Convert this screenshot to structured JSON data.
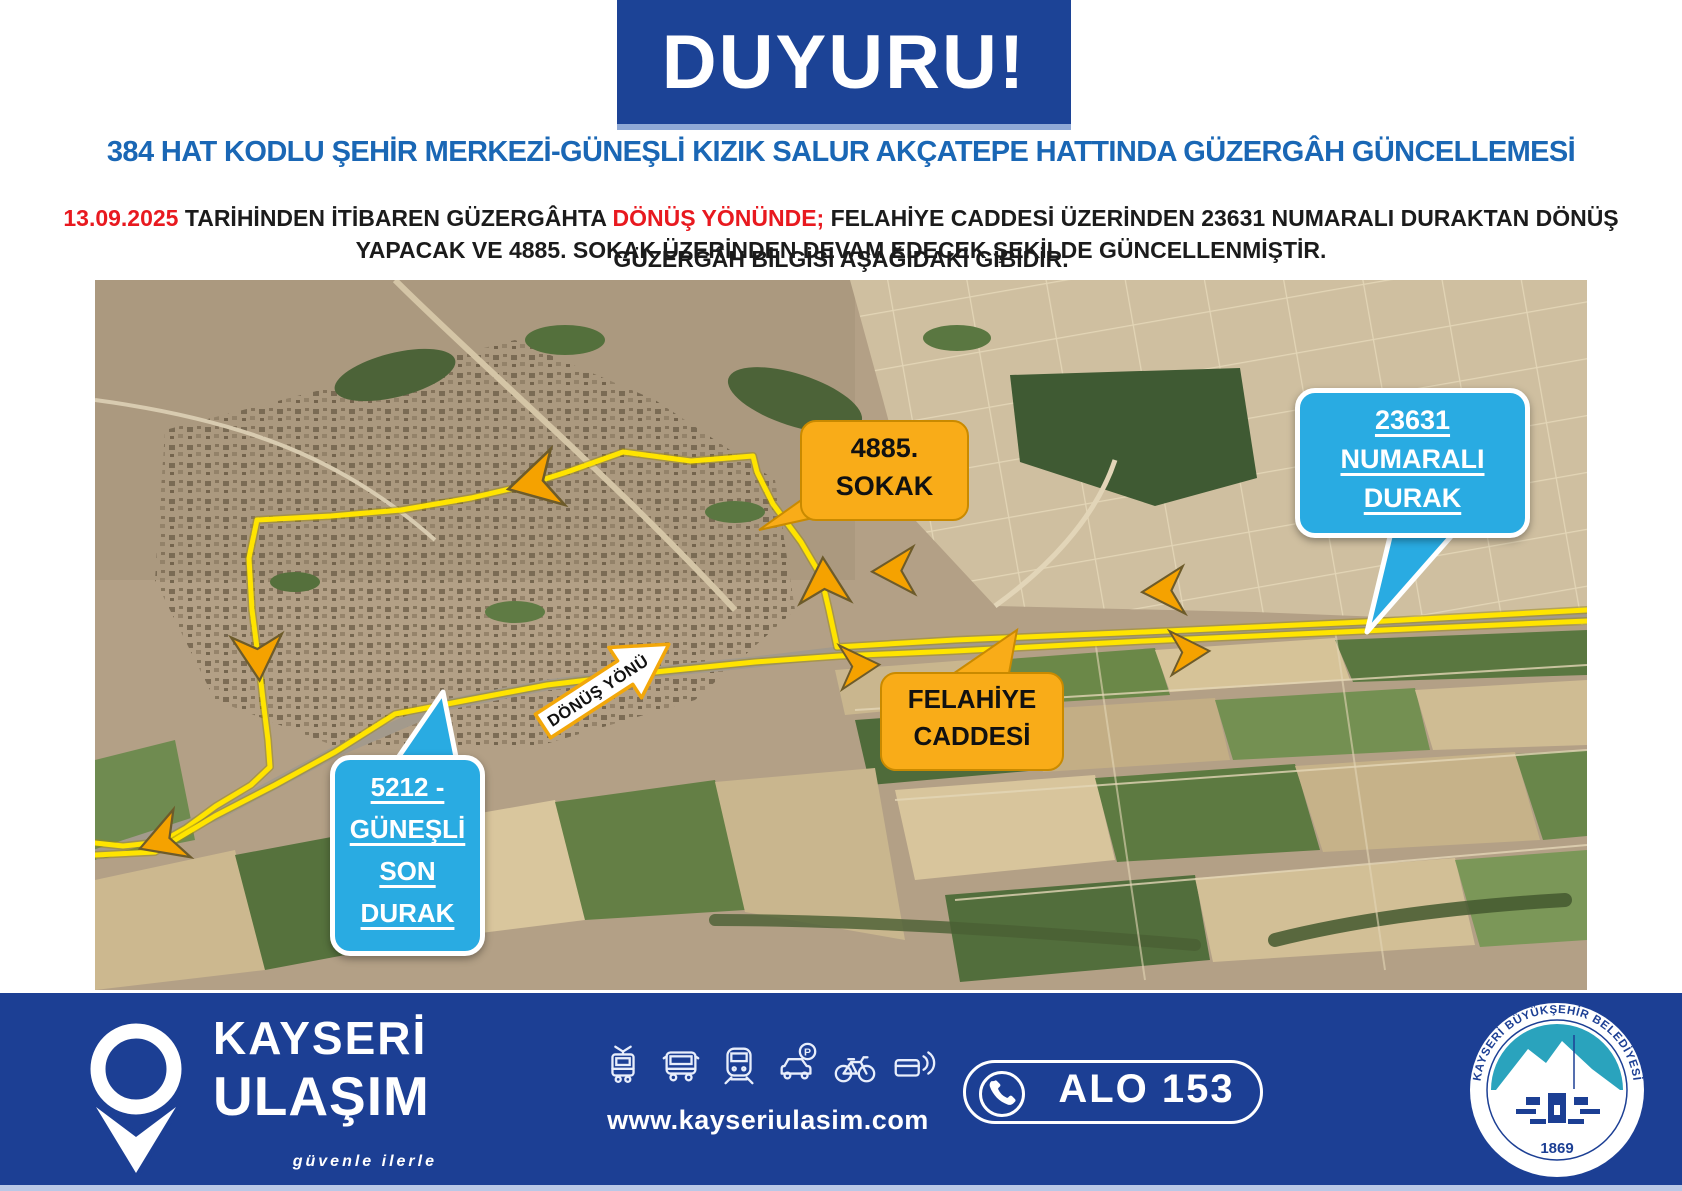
{
  "header": {
    "banner": "DUYURU!",
    "title": "384 HAT KODLU ŞEHİR MERKEZİ-GÜNEŞLİ KIZIK SALUR AKÇATEPE HATTINDA GÜZERGÂH GÜNCELLEMESİ",
    "body": {
      "date": "13.09.2025",
      "seg1": " TARİHİNDEN İTİBAREN GÜZERGÂHTA ",
      "highlight": "DÖNÜŞ YÖNÜNDE;",
      "seg2": " FELAHİYE CADDESİ ÜZERİNDEN 23631 NUMARALI DURAKTAN DÖNÜŞ YAPACAK VE 4885. SOKAK ÜZERİNDEN DEVAM EDECEK ŞEKİLDE GÜNCELLENMİŞTİR."
    },
    "subtitle": "GÜZERGÂH BİLGİSİ AŞAĞIDAKİ GİBİDİR."
  },
  "map": {
    "direction_label": "DÖNÜŞ YÖNÜ",
    "callouts": {
      "sokak4885": {
        "line1": "4885.",
        "line2": "SOKAK"
      },
      "durak23631": {
        "line1": "23631",
        "line2": "NUMARALI",
        "line3": "DURAK"
      },
      "felahiye": {
        "line1": "FELAHİYE",
        "line2": "CADDESİ"
      },
      "gunesli": {
        "line1": "5212 -",
        "line2": "GÜNEŞLİ",
        "line3": "SON",
        "line4": "DURAK"
      }
    }
  },
  "footer": {
    "brand_top": "KAYSERİ",
    "brand_bottom": "ULAŞIM",
    "slogan": "güvenle ilerle",
    "website": "www.kayseriulasim.com",
    "phone": "ALO 153",
    "seal": {
      "ring_text": "KAYSERİ BÜYÜKŞEHİR BELEDİYESİ",
      "year": "1869"
    },
    "icons": [
      "tram-icon",
      "bus-icon",
      "metro-icon",
      "car-parking-icon",
      "bike-icon",
      "contactless-card-icon"
    ]
  },
  "colors": {
    "banner_blue": "#1c4396",
    "footer_blue": "#1c3f94",
    "title_blue": "#1a67b5",
    "alert_red": "#e8191f",
    "route_yellow": "#ffe400",
    "callout_orange": "#f9ac18",
    "callout_blue": "#29abe2"
  }
}
